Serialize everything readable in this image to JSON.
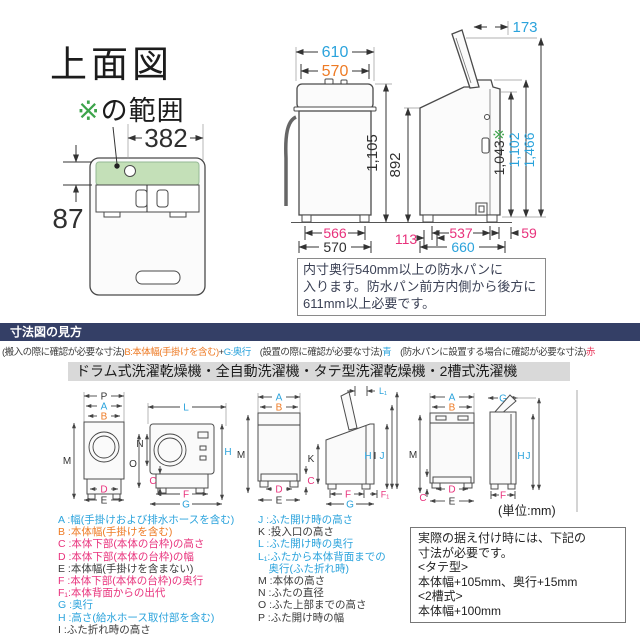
{
  "palette": {
    "blue": "#2BA3DC",
    "orange": "#EE7B25",
    "pink": "#E8327C",
    "green": "#3DA44B",
    "red": "#E83558",
    "dark": "#3A3A3A",
    "navy": "#343F66"
  },
  "top_view": {
    "title": "上面図",
    "range_mark": "※",
    "range_suffix": "の範囲",
    "dim_width": "382",
    "dim_height": "87"
  },
  "front_view": {
    "width_outer": "610",
    "width_body": "570",
    "height_total": "1,105",
    "height_body": "892",
    "base_width": "566",
    "bottom_width": "570",
    "rear_clearance": "113"
  },
  "side_view": {
    "lid_projection": "173",
    "height_ref": "1,043",
    "height_ref_mark": "※",
    "height_lid": "1,102",
    "height_lid_open": "1,466",
    "base_depth": "537",
    "front_overhang": "59",
    "depth_total": "660"
  },
  "note_box": {
    "lines": [
      "内寸奥行540mm以上の防水パンに",
      "入ります。防水パン前方内側から後方に",
      "611mm以上必要です。"
    ]
  },
  "guide": {
    "header": "寸法図の見方",
    "legend_line": [
      {
        "text": "(搬入の際に確認が必要な寸法)",
        "color": "dark"
      },
      {
        "text": "B:本体幅(手掛けを含む)",
        "color": "orange"
      },
      {
        "text": "+",
        "color": "dark"
      },
      {
        "text": "G:奥行",
        "color": "blue"
      },
      {
        "text": "　(設置の際に確認が必要な寸法)",
        "color": "dark"
      },
      {
        "text": "青",
        "color": "blue"
      },
      {
        "text": "　(防水パンに設置する場合に確認が必要な寸法)",
        "color": "dark"
      },
      {
        "text": "赤",
        "color": "red"
      }
    ],
    "machines_bar": "ドラム式洗濯乾燥機・全自動洗濯機・タテ型洗濯乾燥機・2槽式洗濯機",
    "unit": "(単位:mm)"
  },
  "diagram_labels": {
    "drum_front": {
      "p": "P",
      "a": "A",
      "b": "B",
      "m": "M",
      "d": "D",
      "e": "E"
    },
    "drum_side": {
      "l": "L",
      "n": "N",
      "o": "O",
      "h": "H",
      "c": "C",
      "f": "F",
      "g": "G"
    },
    "vertical_front": {
      "a": "A",
      "b": "B",
      "m": "M",
      "c": "C",
      "d": "D",
      "e": "E"
    },
    "vertical_side": {
      "l1": "L₁",
      "k": "K",
      "h": "H",
      "i": "I",
      "j": "J",
      "f": "F",
      "f1": "F₁",
      "g": "G"
    },
    "twin_front": {
      "a": "A",
      "b": "B",
      "m": "M",
      "c": "C",
      "d": "D",
      "e": "E"
    },
    "twin_side": {
      "g": "G",
      "h": "H",
      "j": "J",
      "f": "F"
    }
  },
  "legend_left": [
    {
      "label": "A :幅(手掛けおよび排水ホースを含む)",
      "color": "blue"
    },
    {
      "label": "B :本体幅(手掛けを含む)",
      "color": "orange"
    },
    {
      "label": "C :本体下部(本体の台枠)の高さ",
      "color": "pink"
    },
    {
      "label": "D :本体下部(本体の台枠)の幅",
      "color": "pink"
    },
    {
      "label": "E :本体幅(手掛けを含まない)",
      "color": "dark"
    },
    {
      "label": "F :本体下部(本体の台枠)の奥行",
      "color": "pink"
    },
    {
      "label": "F₁:本体背面からの出代",
      "color": "pink"
    },
    {
      "label": "G :奥行",
      "color": "blue"
    },
    {
      "label": "H :高さ(給水ホース取付部を含む)",
      "color": "blue"
    },
    {
      "label": "I :ふた折れ時の高さ",
      "color": "dark"
    }
  ],
  "legend_right": [
    {
      "label": "J :ふた開け時の高さ",
      "color": "blue"
    },
    {
      "label": "K :投入口の高さ",
      "color": "dark"
    },
    {
      "label": "L :ふた開け時の奥行",
      "color": "blue"
    },
    {
      "label": "L₁:ふたから本体背面までの",
      "color": "blue"
    },
    {
      "label": "　奥行(ふた折れ時)",
      "color": "blue"
    },
    {
      "label": "M :本体の高さ",
      "color": "dark"
    },
    {
      "label": "N :ふたの直径",
      "color": "dark"
    },
    {
      "label": "O :ふた上部までの高さ",
      "color": "dark"
    },
    {
      "label": "P :ふた開け時の幅",
      "color": "dark"
    }
  ],
  "install_box": {
    "lines": [
      "実際の据え付け時には、下記の",
      "寸法が必要です。",
      "<タテ型>",
      "本体幅+105mm、奥行+15mm",
      "<2槽式>",
      "本体幅+100mm"
    ]
  }
}
